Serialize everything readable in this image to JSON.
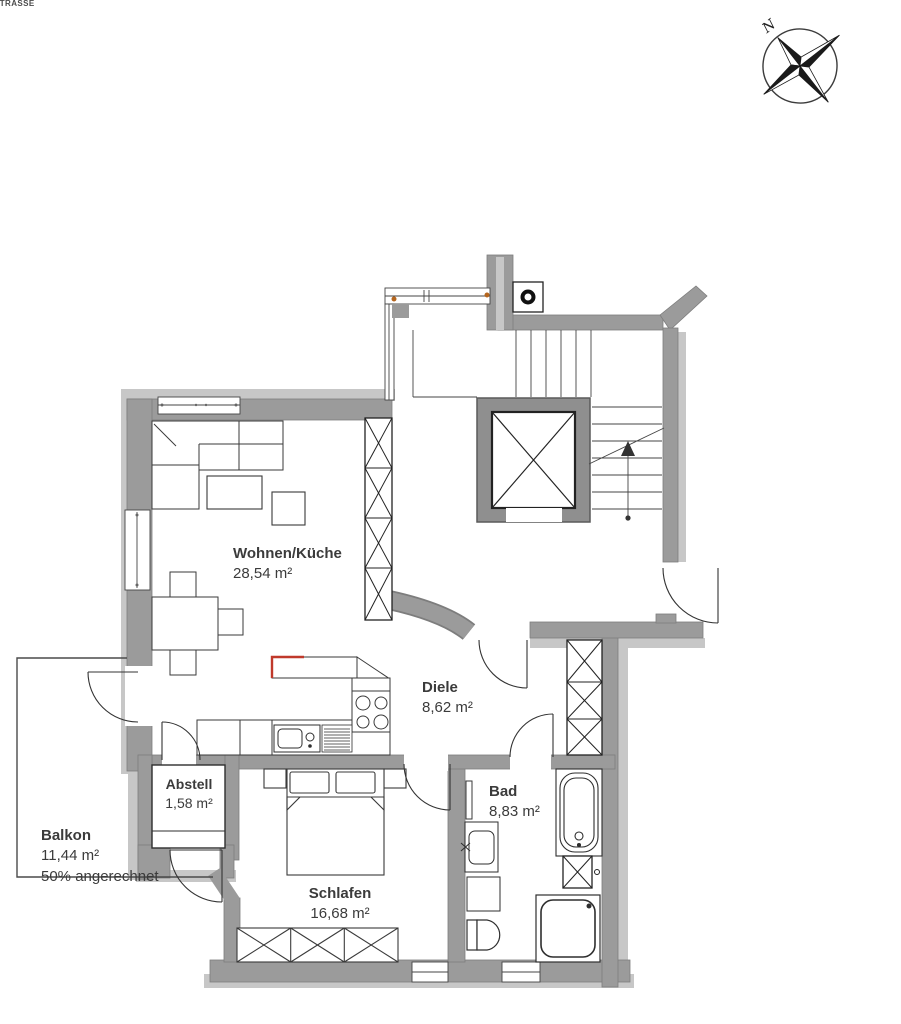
{
  "street_label": "Strasse",
  "compass": {
    "north_label": "N"
  },
  "rooms": {
    "wohnen_kueche": {
      "name": "Wohnen/Küche",
      "area": "28,54 m²"
    },
    "diele": {
      "name": "Diele",
      "area": "8,62 m²"
    },
    "abstell": {
      "name": "Abstell",
      "area": "1,58 m²"
    },
    "balkon": {
      "name": "Balkon",
      "area": "11,44 m²",
      "note": "50% angerechnet"
    },
    "schlafen": {
      "name": "Schlafen",
      "area": "16,68 m²"
    },
    "bad": {
      "name": "Bad",
      "area": "8,83 m²"
    }
  },
  "colors": {
    "wall": "#9b9b9b",
    "wall_light": "#c7c7c7",
    "wall_outline": "#7d7d7d",
    "line": "#3a3a3a",
    "accent_red": "#c0392b",
    "accent_wood": "#b5651d",
    "text": "#3b3b3b"
  }
}
